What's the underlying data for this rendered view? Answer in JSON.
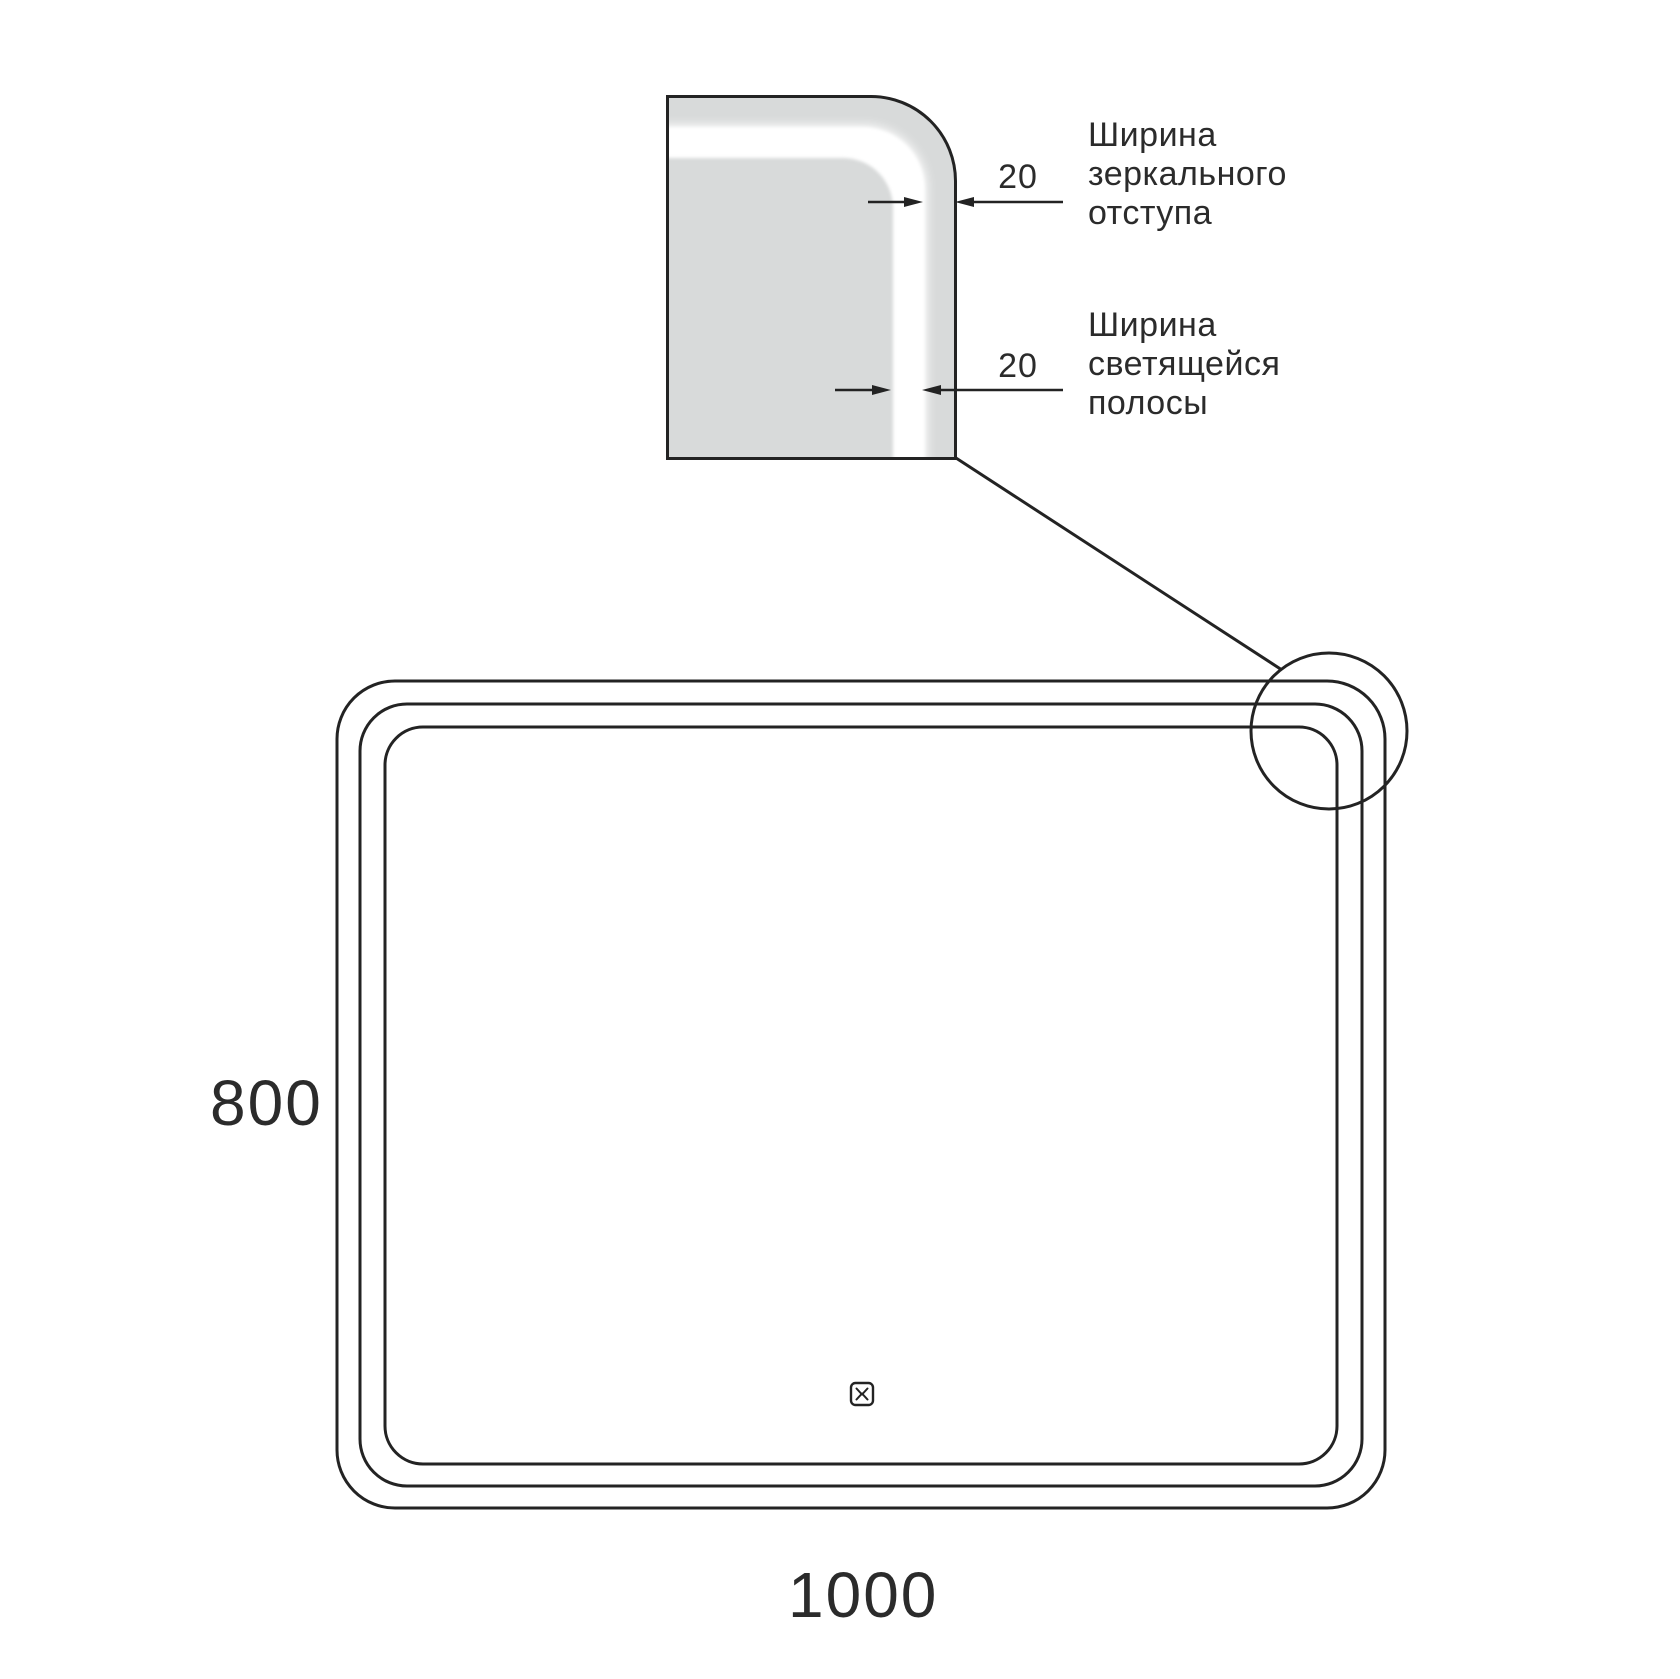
{
  "diagram": {
    "detail": {
      "dim_offset": {
        "value": "20",
        "label_lines": [
          "Ширина",
          "зеркального",
          "отступа"
        ]
      },
      "dim_strip": {
        "value": "20",
        "label_lines": [
          "Ширина",
          "светящейся",
          "полосы"
        ]
      }
    },
    "dimensions": {
      "height": "800",
      "width": "1000"
    },
    "icons": {
      "touch_button": "touch-button-icon",
      "magnifier": "magnifier-circle"
    },
    "colors": {
      "line": "#232323",
      "mirror_fill": "#d8dada",
      "glow_strip": "#ffffff",
      "background": "#ffffff"
    }
  }
}
